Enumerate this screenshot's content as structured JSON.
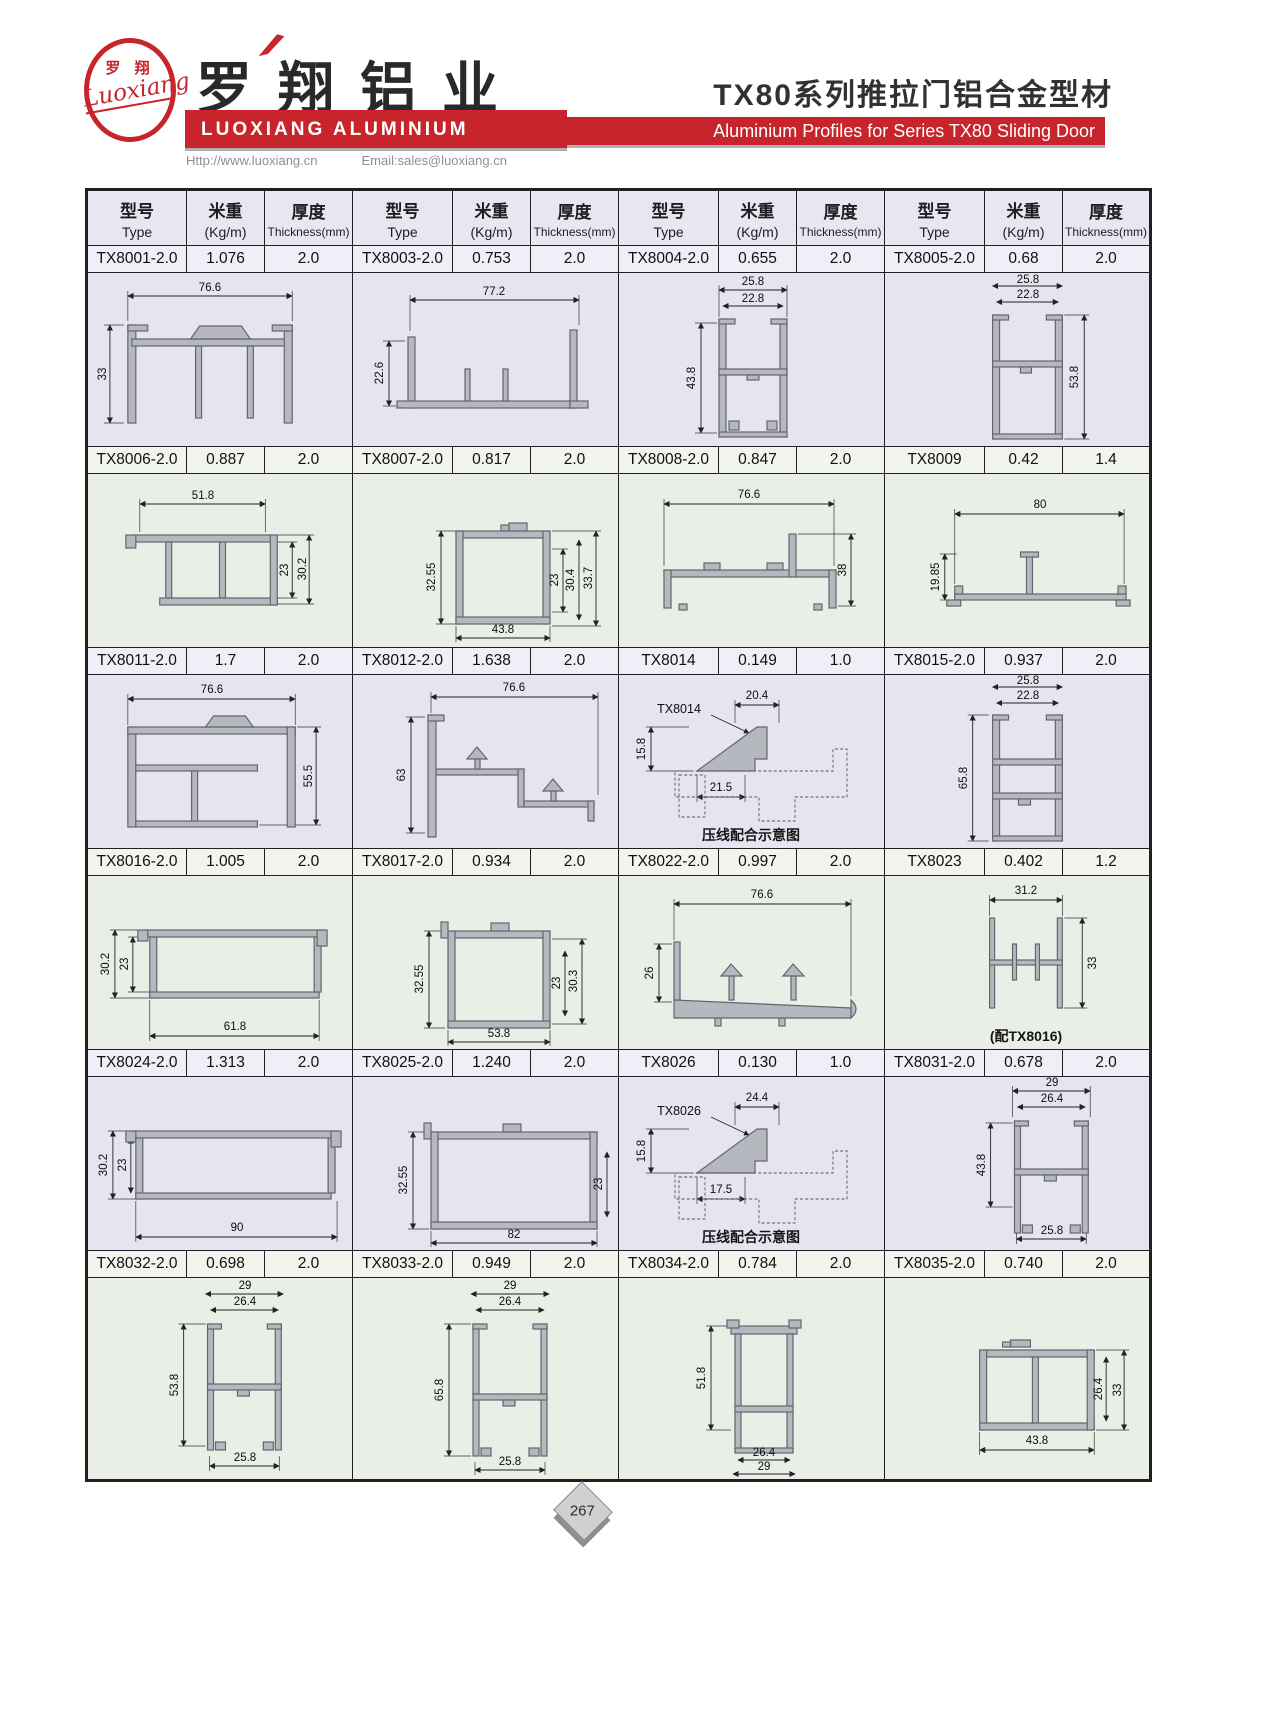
{
  "brand": {
    "logo_zh": "罗 翔",
    "logo_script": "Luoxiang",
    "company_zh": "罗翔铝业",
    "company_en": "LUOXIANG ALUMINIUM",
    "url": "Http://www.luoxiang.cn",
    "email": "Email:sales@luoxiang.cn",
    "red": "#c8242b"
  },
  "title": {
    "zh": "TX80系列推拉门铝合金型材",
    "en": "Aluminium Profiles for Series TX80 Sliding Door"
  },
  "table": {
    "headers": {
      "type_zh": "型号",
      "type_en": "Type",
      "weight_zh": "米重",
      "weight_en": "(Kg/m)",
      "thick_zh": "厚度",
      "thick_en": "Thickness(mm)"
    },
    "rows": [
      {
        "profiles": [
          {
            "type": "TX8001-2.0",
            "weight": "1.076",
            "thickness": "2.0",
            "dims": {
              "d1": "76.6",
              "d2": "33"
            }
          },
          {
            "type": "TX8003-2.0",
            "weight": "0.753",
            "thickness": "2.0",
            "dims": {
              "d1": "77.2",
              "d2": "22.6"
            }
          },
          {
            "type": "TX8004-2.0",
            "weight": "0.655",
            "thickness": "2.0",
            "dims": {
              "d1": "25.8",
              "d2": "22.8",
              "d3": "43.8"
            }
          },
          {
            "type": "TX8005-2.0",
            "weight": "0.68",
            "thickness": "2.0",
            "dims": {
              "d1": "25.8",
              "d2": "22.8",
              "d3": "53.8"
            }
          }
        ]
      },
      {
        "profiles": [
          {
            "type": "TX8006-2.0",
            "weight": "0.887",
            "thickness": "2.0",
            "dims": {
              "d1": "51.8",
              "d2": "23",
              "d3": "30.2"
            }
          },
          {
            "type": "TX8007-2.0",
            "weight": "0.817",
            "thickness": "2.0",
            "dims": {
              "d1": "32.55",
              "d2": "43.8",
              "d3": "23",
              "d4": "30.4",
              "d5": "33.7"
            }
          },
          {
            "type": "TX8008-2.0",
            "weight": "0.847",
            "thickness": "2.0",
            "dims": {
              "d1": "76.6",
              "d2": "38"
            }
          },
          {
            "type": "TX8009",
            "weight": "0.42",
            "thickness": "1.4",
            "dims": {
              "d1": "80",
              "d2": "19.85"
            }
          }
        ]
      },
      {
        "profiles": [
          {
            "type": "TX8011-2.0",
            "weight": "1.7",
            "thickness": "2.0",
            "dims": {
              "d1": "76.6",
              "d2": "55.5"
            }
          },
          {
            "type": "TX8012-2.0",
            "weight": "1.638",
            "thickness": "2.0",
            "dims": {
              "d1": "76.6",
              "d2": "63"
            }
          },
          {
            "type": "TX8014",
            "weight": "0.149",
            "thickness": "1.0",
            "label": "TX8014",
            "caption": "压线配合示意图",
            "dims": {
              "d1": "20.4",
              "d2": "15.8",
              "d3": "21.5"
            }
          },
          {
            "type": "TX8015-2.0",
            "weight": "0.937",
            "thickness": "2.0",
            "dims": {
              "d1": "25.8",
              "d2": "22.8",
              "d3": "65.8"
            }
          }
        ]
      },
      {
        "profiles": [
          {
            "type": "TX8016-2.0",
            "weight": "1.005",
            "thickness": "2.0",
            "dims": {
              "d1": "30.2",
              "d2": "23",
              "d3": "61.8"
            }
          },
          {
            "type": "TX8017-2.0",
            "weight": "0.934",
            "thickness": "2.0",
            "dims": {
              "d1": "32.55",
              "d2": "23",
              "d3": "30.3",
              "d4": "53.8"
            }
          },
          {
            "type": "TX8022-2.0",
            "weight": "0.997",
            "thickness": "2.0",
            "dims": {
              "d1": "76.6",
              "d2": "26"
            }
          },
          {
            "type": "TX8023",
            "weight": "0.402",
            "thickness": "1.2",
            "caption": "(配TX8016)",
            "dims": {
              "d1": "31.2",
              "d2": "33"
            }
          }
        ]
      },
      {
        "profiles": [
          {
            "type": "TX8024-2.0",
            "weight": "1.313",
            "thickness": "2.0",
            "dims": {
              "d1": "30.2",
              "d2": "23",
              "d3": "90"
            }
          },
          {
            "type": "TX8025-2.0",
            "weight": "1.240",
            "thickness": "2.0",
            "dims": {
              "d1": "32.55",
              "d2": "23",
              "d3": "82"
            }
          },
          {
            "type": "TX8026",
            "weight": "0.130",
            "thickness": "1.0",
            "label": "TX8026",
            "caption": "压线配合示意图",
            "dims": {
              "d1": "24.4",
              "d2": "15.8",
              "d3": "17.5"
            }
          },
          {
            "type": "TX8031-2.0",
            "weight": "0.678",
            "thickness": "2.0",
            "dims": {
              "d1": "29",
              "d2": "26.4",
              "d3": "43.8",
              "d4": "25.8"
            }
          }
        ]
      },
      {
        "profiles": [
          {
            "type": "TX8032-2.0",
            "weight": "0.698",
            "thickness": "2.0",
            "dims": {
              "d1": "29",
              "d2": "26.4",
              "d3": "53.8",
              "d4": "25.8"
            }
          },
          {
            "type": "TX8033-2.0",
            "weight": "0.949",
            "thickness": "2.0",
            "dims": {
              "d1": "29",
              "d2": "26.4",
              "d3": "65.8",
              "d4": "25.8"
            }
          },
          {
            "type": "TX8034-2.0",
            "weight": "0.784",
            "thickness": "2.0",
            "dims": {
              "d1": "51.8",
              "d2": "26.4",
              "d3": "29"
            }
          },
          {
            "type": "TX8035-2.0",
            "weight": "0.740",
            "thickness": "2.0",
            "dims": {
              "d1": "26.4",
              "d2": "33",
              "d3": "43.8"
            }
          }
        ]
      }
    ]
  },
  "footer": {
    "page": "267"
  }
}
